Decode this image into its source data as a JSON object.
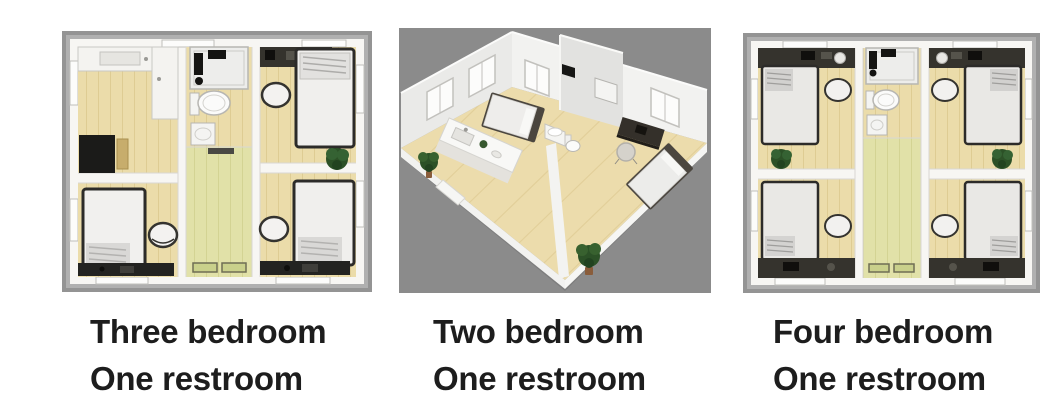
{
  "panels": [
    {
      "name": "three-bedroom-plan",
      "view": "top-down",
      "caption": {
        "line1": "Three bedroom",
        "line2": "One restroom"
      }
    },
    {
      "name": "two-bedroom-plan",
      "view": "isometric-3d",
      "caption": {
        "line1": "Two bedroom",
        "line2": "One restroom"
      }
    },
    {
      "name": "four-bedroom-plan",
      "view": "top-down",
      "caption": {
        "line1": "Four bedroom",
        "line2": "One restroom"
      }
    }
  ],
  "colors": {
    "caption_text": "#1d1d1d",
    "plan_frame_gray": "#9b9b9b",
    "iso_background_gray": "#8b8b8b",
    "floor_wood_tan": "#ebdcaa",
    "hallway_green_tan": "#e1e1a8",
    "wall_white": "#f7f6f3",
    "furniture_dark": "#232321",
    "plant_green": "#2c5127"
  }
}
